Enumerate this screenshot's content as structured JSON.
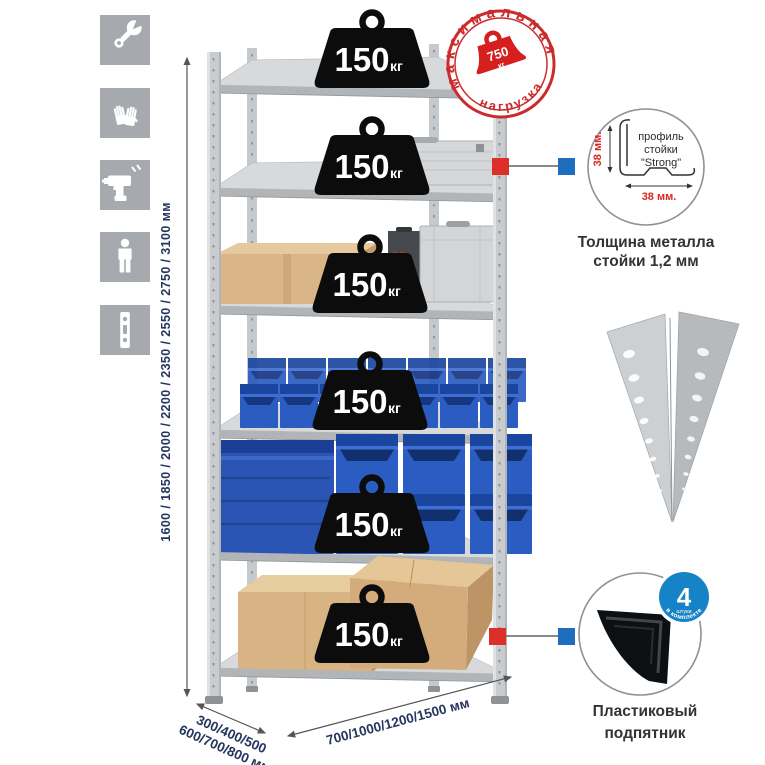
{
  "left_toolbar": {
    "icons": [
      {
        "name": "wrench-icon"
      },
      {
        "name": "gloves-icon"
      },
      {
        "name": "drill-icon"
      },
      {
        "name": "person-icon"
      },
      {
        "name": "post-profile-icon"
      }
    ]
  },
  "rack": {
    "shelf_count": 6,
    "weights": [
      {
        "value": "150",
        "unit": "кг"
      },
      {
        "value": "150",
        "unit": "кг"
      },
      {
        "value": "150",
        "unit": "кг"
      },
      {
        "value": "150",
        "unit": "кг"
      },
      {
        "value": "150",
        "unit": "кг"
      },
      {
        "value": "150",
        "unit": "кг"
      }
    ]
  },
  "max_load_stamp": {
    "top_text": "максимальная",
    "bottom_text": "нагрузка",
    "value": "750",
    "unit": "кг"
  },
  "dimensions": {
    "height": "1600 / 1850 / 2000 / 2200 / 2350 / 2550 / 2750 / 3100 мм",
    "depth_line1": "300/400/500",
    "depth_line2": "600/700/800 мм",
    "width": "700/1000/1200/1500 мм"
  },
  "profile_detail": {
    "label_line1": "профиль",
    "label_line2": "стойки",
    "label_line3": "\"Strong\"",
    "vertical_dim": "38 мм.",
    "horizontal_dim": "38 мм.",
    "caption_line1": "Толщина металла",
    "caption_line2": "стойки 1,2 мм"
  },
  "foot_detail": {
    "badge_value": "4",
    "badge_sub": "штуки",
    "badge_arc": "в комплекте",
    "caption_line1": "Пластиковый",
    "caption_line2": "подпятник"
  },
  "colors": {
    "stamp_red": "#cd2a2c",
    "marker_red": "#dd2f2a",
    "marker_blue": "#1d6fbe",
    "badge_blue": "#1583c5",
    "bin_blue": "#2b5cc1",
    "dim_text": "#24365e"
  }
}
